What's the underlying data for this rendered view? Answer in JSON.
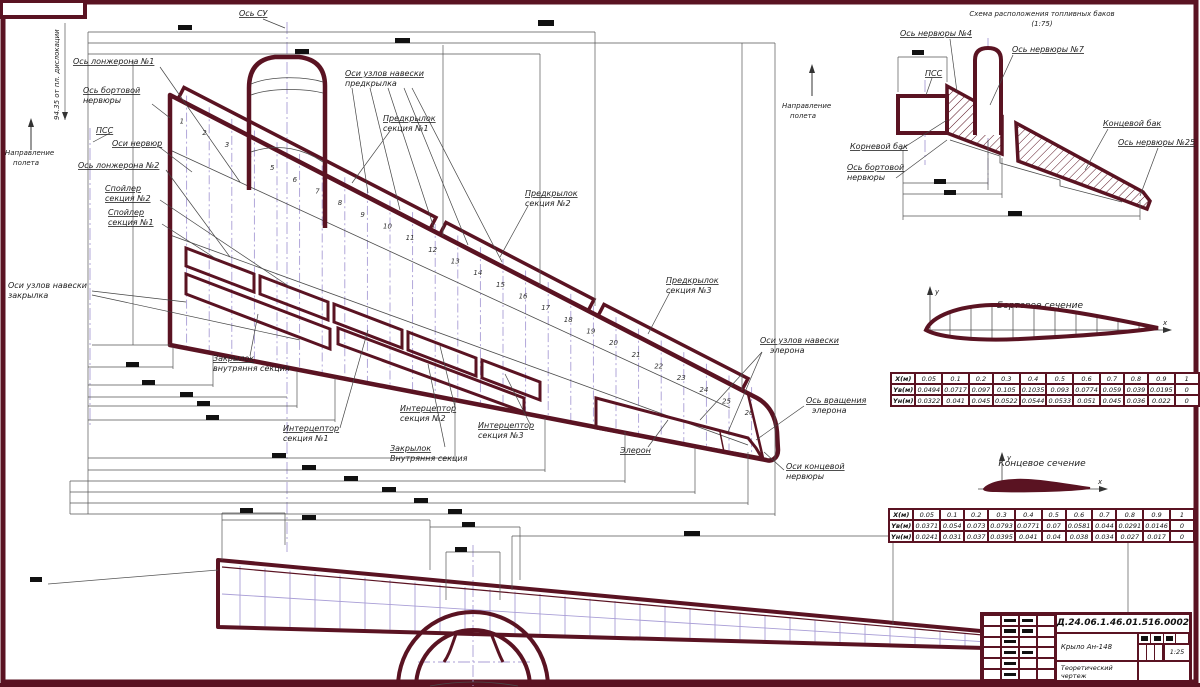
{
  "page": {
    "accent_color": "#5a1322",
    "axis_color": "#a99ed6",
    "line_color": "#4a4a4a"
  },
  "direction": {
    "line1": "Направление",
    "line2": "полета"
  },
  "plan_view": {
    "labels": {
      "os_su": "Ось СУ",
      "spar1_axis": "Ось лонжерона №1",
      "board_rib_1": "Ось бортовой",
      "board_rib_2": "нервюры",
      "pss": "ПСС",
      "rib_axes": "Оси нервюр",
      "spar2_axis": "Ось лонжерона №2",
      "spoiler2_1": "Спойлер",
      "spoiler2_2": "секция №2",
      "spoiler1_1": "Спойлер",
      "spoiler1_2": "секция №1",
      "slat_hinge_1": "Оси узлов навески",
      "slat_hinge_2": "предкрылка",
      "slat1_1": "Предкрылок",
      "slat1_2": "секция №1",
      "slat2_1": "Предкрылок",
      "slat2_2": "секция №2",
      "slat3_1": "Предкрылок",
      "slat3_2": "секция №3",
      "flap_hinge_1": "Оси узлов навески",
      "flap_hinge_2": "закрылка",
      "flap_in1_1": "Закрылок",
      "flap_in1_2": "внутряння секция",
      "int1_1": "Интерцептор",
      "int1_2": "секция №1",
      "int2_1": "Интерцептор",
      "int2_2": "секция №2",
      "int3_1": "Интерцептор",
      "int3_2": "секция №3",
      "flap_in2_1": "Закрылок",
      "flap_in2_2": "Внутряння секция",
      "aileron": "Элерон",
      "ail_hinge_1": "Оси узлов навески",
      "ail_hinge_2": "элерона",
      "ail_axis_1": "Ось вращения",
      "ail_axis_2": "элерона",
      "tip_rib_1": "Оси концевой",
      "tip_rib_2": "нервюры",
      "station": "94.35 от пл. дислокации"
    },
    "rib_numbers": [
      "1",
      "2",
      "3",
      "4",
      "5",
      "6",
      "7",
      "8",
      "9",
      "10",
      "11",
      "12",
      "13",
      "14",
      "15",
      "16",
      "17",
      "18",
      "19",
      "20",
      "21",
      "22",
      "23",
      "24",
      "25",
      "26"
    ]
  },
  "fuel_scheme": {
    "title": "Схема расположения топливных баков",
    "scale_note": "(1:75)",
    "labels": {
      "rib4": "Ось нервюры №4",
      "rib7": "Ось нервюры №7",
      "pss": "ПСС",
      "root_tank": "Корневой бак",
      "board_rib_1": "Ось бортовой",
      "board_rib_2": "нервюры",
      "tip_tank": "Концевой бак",
      "rib25": "Ось нервюры №25"
    }
  },
  "sections": {
    "board": {
      "title": "Бортовое сечение",
      "axis_x": "x",
      "axis_y": "y",
      "table": {
        "rows": [
          {
            "h": "X(м)",
            "v": [
              "0.05",
              "0.1",
              "0.2",
              "0.3",
              "0.4",
              "0.5",
              "0.6",
              "0.7",
              "0.8",
              "0.9",
              "1"
            ]
          },
          {
            "h": "Yв(м)",
            "v": [
              "0.0494",
              "0.0717",
              "0.097",
              "0.105",
              "0.1035",
              "0.093",
              "0.0774",
              "0.059",
              "0.039",
              "0.0195",
              "0"
            ]
          },
          {
            "h": "Yн(м)",
            "v": [
              "0.0322",
              "0.041",
              "0.045",
              "0.0522",
              "0.0544",
              "0.0533",
              "0.051",
              "0.045",
              "0.036",
              "0.022",
              "0"
            ]
          }
        ]
      }
    },
    "tip": {
      "title": "Концевое сечение",
      "axis_x": "x",
      "axis_y": "y",
      "table": {
        "rows": [
          {
            "h": "X(м)",
            "v": [
              "0.05",
              "0.1",
              "0.2",
              "0.3",
              "0.4",
              "0.5",
              "0.6",
              "0.7",
              "0.8",
              "0.9",
              "1"
            ]
          },
          {
            "h": "Yв(м)",
            "v": [
              "0.0371",
              "0.054",
              "0.073",
              "0.0793",
              "0.0771",
              "0.07",
              "0.0581",
              "0.044",
              "0.0291",
              "0.0146",
              "0"
            ]
          },
          {
            "h": "Yн(м)",
            "v": [
              "0.0241",
              "0.031",
              "0.037",
              "0.0395",
              "0.041",
              "0.04",
              "0.038",
              "0.034",
              "0.027",
              "0.017",
              "0"
            ]
          }
        ]
      }
    }
  },
  "title_block": {
    "code": "Д.24.06.1.46.01.516.0002",
    "name": "Крыло Ан-148",
    "doc_type_1": "Теоретический",
    "doc_type_2": "чертеж",
    "scale": "1:25"
  }
}
